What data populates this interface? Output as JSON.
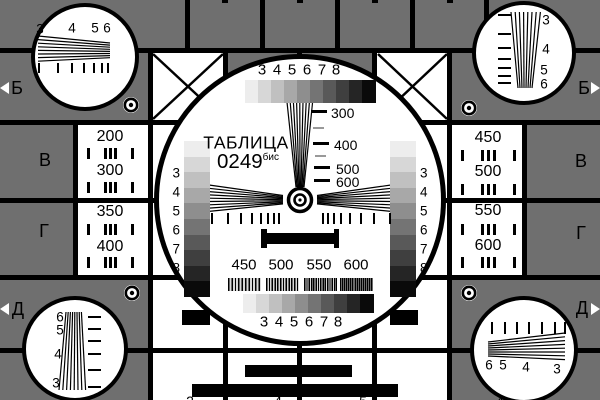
{
  "card": {
    "title": "ТАБЛИЦА",
    "code": "0249",
    "code_suffix": "бис"
  },
  "colors": {
    "field_gray": "#6f6f6f",
    "white": "#ffffff",
    "black": "#000000",
    "grating_bg": "#d8d8d8",
    "grayscale_steps": [
      "#ededed",
      "#d7d7d7",
      "#c0c0c0",
      "#a8a8a8",
      "#8e8e8e",
      "#747474",
      "#595959",
      "#3f3f3f",
      "#252525",
      "#0a0a0a"
    ]
  },
  "center_circle": {
    "top_grayscale_labels": [
      "3",
      "4",
      "5",
      "6",
      "7",
      "8"
    ],
    "bottom_grayscale_labels": [
      "3",
      "4",
      "5",
      "6",
      "7",
      "8"
    ],
    "left_column_labels": [
      "3",
      "4",
      "5",
      "6",
      "7",
      "8"
    ],
    "right_column_labels": [
      "3",
      "4",
      "5",
      "6",
      "7",
      "8"
    ],
    "vertical_wedge_labels": [
      "300",
      "400",
      "500",
      "600"
    ],
    "frequency_labels": [
      "450",
      "500",
      "550",
      "600"
    ]
  },
  "side_cells": {
    "left_top": [
      "200",
      "300"
    ],
    "left_bottom": [
      "350",
      "400"
    ],
    "right_top": [
      "450",
      "500"
    ],
    "right_bottom": [
      "550",
      "600"
    ]
  },
  "edge_markers": {
    "left": [
      "Б",
      "В",
      "Г",
      "Д"
    ],
    "right": [
      "Б",
      "В",
      "Г",
      "Д"
    ]
  },
  "corner_circles": {
    "top_left_labels": [
      "3",
      "4",
      "5",
      "6"
    ],
    "top_right_labels": [
      "3",
      "4",
      "5",
      "6"
    ],
    "bottom_left_labels": [
      "6",
      "5",
      "4",
      "3"
    ],
    "bottom_right_labels": [
      "6",
      "5",
      "4",
      "3"
    ]
  },
  "bottom_edge_fragments": [
    "2",
    "4",
    "5",
    "4"
  ]
}
